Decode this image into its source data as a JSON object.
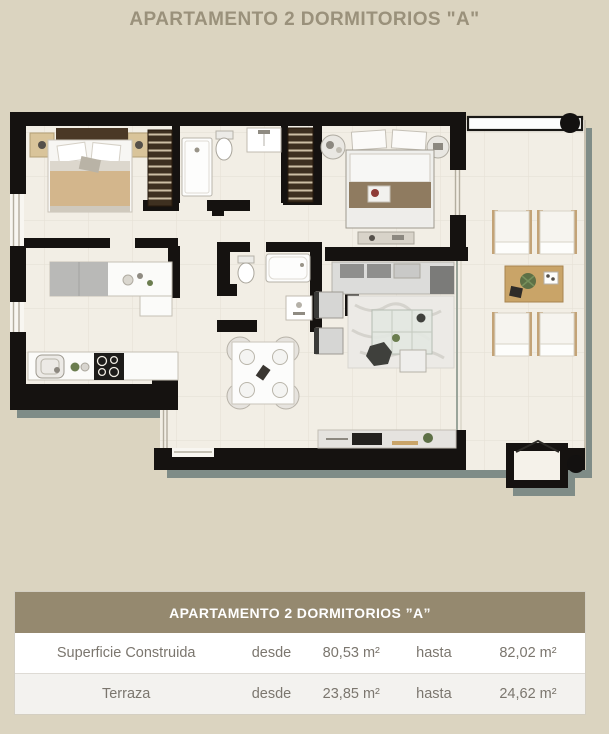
{
  "page": {
    "title": "APARTAMENTO 2 DORMITORIOS \"A\""
  },
  "table": {
    "header": "APARTAMENTO 2 DORMITORIOS ”A”",
    "rows": [
      {
        "label": "Superficie Construida",
        "from_label": "desde",
        "from_value": "80,53 m²",
        "to_label": "hasta",
        "to_value": "82,02 m²"
      },
      {
        "label": "Terraza",
        "from_label": "desde",
        "from_value": "23,85 m²",
        "to_label": "hasta",
        "to_value": "24,62 m²"
      }
    ]
  },
  "colors": {
    "background": "#dbd4c0",
    "wall": "#151210",
    "floor": "#f2eee5",
    "shadow": "#7f8c87",
    "table_header_bg": "#95896f",
    "wood_accent": "#c9a468",
    "bed_blanket": "#d3b68c"
  }
}
